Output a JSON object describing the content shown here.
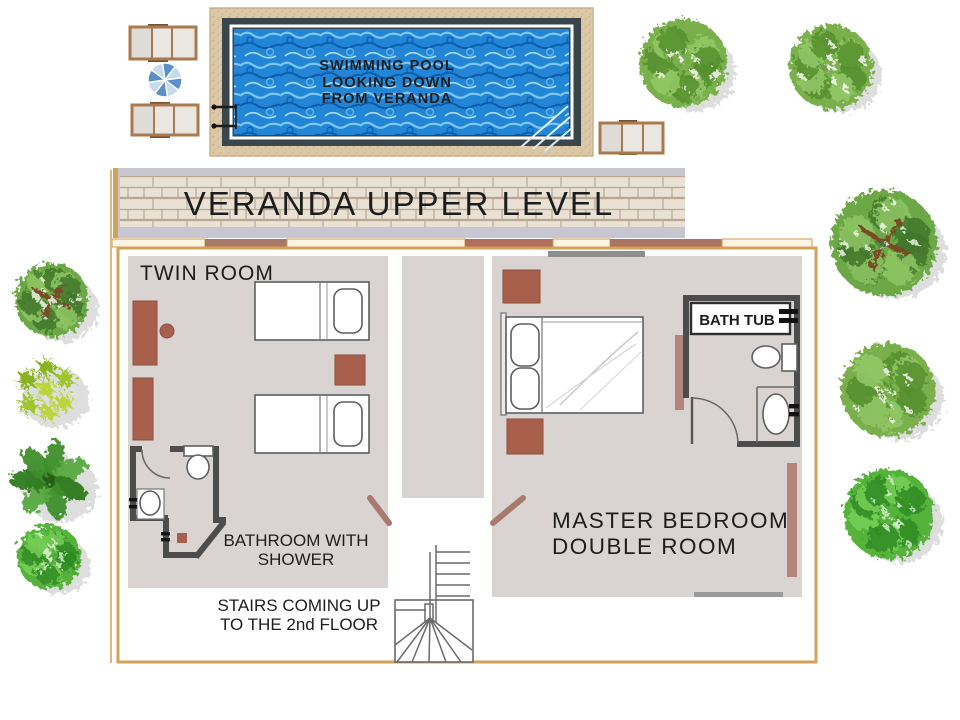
{
  "diagram": {
    "type": "floor-plan",
    "pool": {
      "label_line1": "SWIMMING POOL",
      "label_line2": "LOOKING DOWN",
      "label_line3": "FROM VERANDA"
    },
    "veranda": {
      "label": "VERANDA UPPER LEVEL"
    },
    "rooms": {
      "twin_room": {
        "label": "TWIN ROOM"
      },
      "master_bedroom": {
        "label_line1": "MASTER BEDROOM",
        "label_line2": "DOUBLE ROOM"
      },
      "ensuite_bathroom": {
        "bathtub_label": "BATH TUB"
      },
      "shower_bathroom": {
        "label_line1": "BATHROOM WITH",
        "label_line2": "SHOWER"
      },
      "stairs": {
        "label_line1": "STAIRS COMING UP",
        "label_line2": "TO THE 2nd FLOOR"
      }
    },
    "decor": {
      "plants": [
        "bush",
        "branch-tree",
        "star-plant",
        "palm-plant"
      ],
      "pool_furniture": [
        "sun-lounger",
        "parasol"
      ]
    },
    "colors": {
      "pool_blue": "#2285d6",
      "pool_deck_tan": "#dcc8a6",
      "house_border_gold": "#d2a258",
      "floor_gray": "#d9d3d1",
      "wall_dark": "#4c4c4c",
      "furniture_brown": "#a8604c",
      "accent_mauve": "#b5857d",
      "door_marker": "#a87a6e",
      "foliage_green": "#7ab04b"
    }
  }
}
